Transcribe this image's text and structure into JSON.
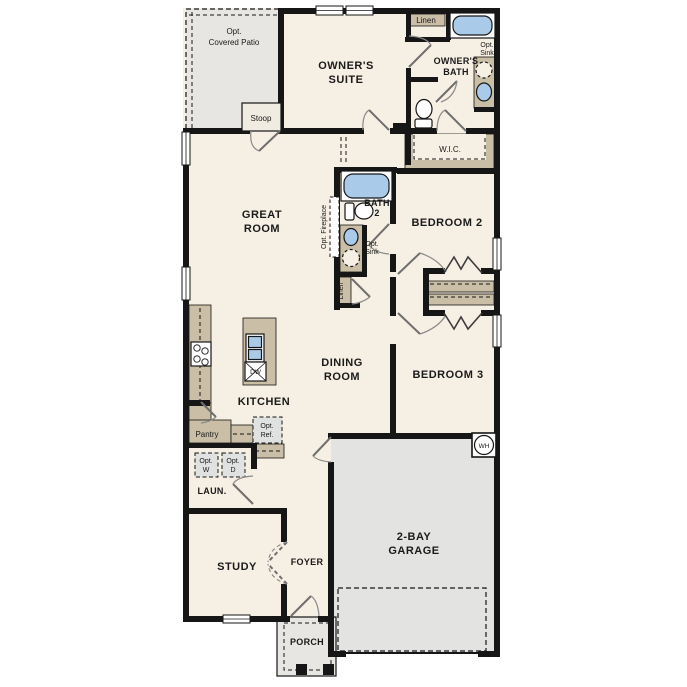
{
  "plan": {
    "type": "single-story floor plan",
    "colors": {
      "wall": "#161616",
      "floor": "#f6efe3",
      "exterior_concrete": "#e7e6e3",
      "garage_floor": "#e3e3e1",
      "cabinet": "#cabfa6",
      "fixture_blue": "#aacae9",
      "optional_appliance": "#e0e1e1",
      "door_swing": "#8a8a8a"
    }
  },
  "rooms": {
    "owners_suite": [
      "OWNER'S",
      "SUITE"
    ],
    "owners_bath": [
      "OWNER'S",
      "BATH"
    ],
    "wic": "W.I.C.",
    "great_room": [
      "GREAT",
      "ROOM"
    ],
    "bath2": [
      "BATH",
      "2"
    ],
    "bedroom2": "BEDROOM 2",
    "bedroom3": "BEDROOM 3",
    "dining_room": [
      "DINING",
      "ROOM"
    ],
    "kitchen": "KITCHEN",
    "laundry": "LAUN.",
    "study": "STUDY",
    "foyer": "FOYER",
    "garage": [
      "2-BAY",
      "GARAGE"
    ],
    "porch": "PORCH"
  },
  "features": {
    "opt_covered_patio": [
      "Opt.",
      "Covered Patio"
    ],
    "stoop": "Stoop",
    "linen_upper": "Linen",
    "linen_hall": "Linen",
    "opt_sink_owners": [
      "Opt.",
      "Sink"
    ],
    "opt_sink_bath2": [
      "Opt.",
      "Sink"
    ],
    "opt_fireplace": "Opt. Fireplace",
    "pantry": "Pantry",
    "opt_ref": [
      "Opt.",
      "Ref."
    ],
    "opt_washer": [
      "Opt.",
      "W"
    ],
    "opt_dryer": [
      "Opt.",
      "D"
    ],
    "dishwasher": "DW",
    "water_heater": "WH"
  }
}
